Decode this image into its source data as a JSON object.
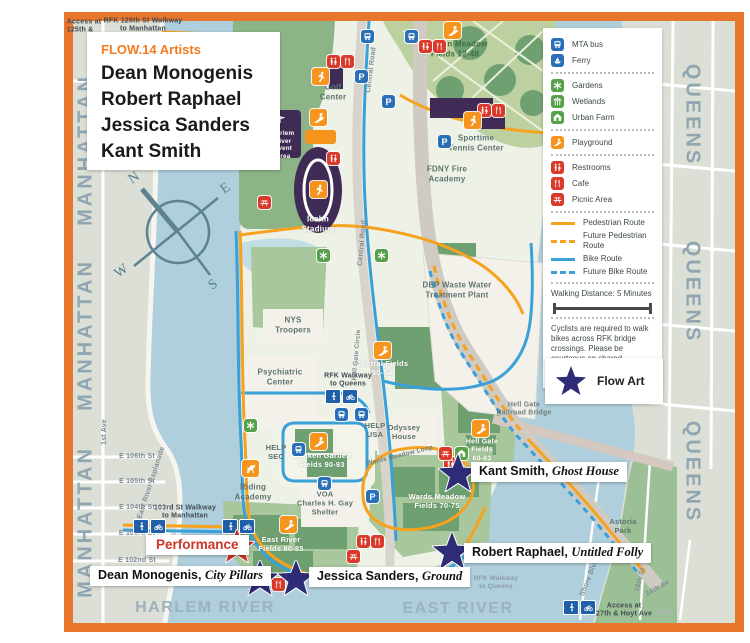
{
  "header": {
    "title": "FLOW.14 Artists",
    "artists": [
      "Dean Monogenis",
      "Robert Raphael",
      "Jessica Sanders",
      "Kant Smith"
    ]
  },
  "legend": {
    "items": [
      {
        "label": "MTA bus",
        "icon": "bus"
      },
      {
        "label": "Ferry",
        "icon": "ferry"
      },
      {
        "label": "Gardens",
        "icon": "gardens"
      },
      {
        "label": "Wetlands",
        "icon": "wetlands"
      },
      {
        "label": "Urban Farm",
        "icon": "urban-farm"
      },
      {
        "label": "Playground",
        "icon": "playground"
      },
      {
        "label": "Restrooms",
        "icon": "restrooms"
      },
      {
        "label": "Cafe",
        "icon": "cafe"
      },
      {
        "label": "Picnic Area",
        "icon": "picnic"
      }
    ],
    "routes": [
      {
        "label": "Pedestrian Route"
      },
      {
        "label": "Future Pedestrian Route"
      },
      {
        "label": "Bike Route"
      },
      {
        "label": "Future Bike Route"
      }
    ],
    "walking_distance": "Walking Distance: 5 Minutes",
    "note": "Cyclists are required to walk bikes across RFK bridge crossings. Please be courteous on shared pathways.",
    "flow_art": "Flow Art"
  },
  "compass": {
    "n": "N",
    "e": "E",
    "s": "S",
    "w": "W"
  },
  "borders": {
    "manhattan": "MANHATTAN",
    "queens": "QUEENS",
    "harlem_river": "HARLEM RIVER",
    "east_river": "EAST RIVER"
  },
  "streets": {
    "access_125": "Access at\n125th &",
    "rfk_125": "RFK 125th St Walkway\nto Manhattan",
    "first_ave": "1st Ave",
    "e106": "E 106th St",
    "e105": "E 105th St",
    "e104": "E 104th St",
    "e103": "E 103rd St",
    "e102": "E 102nd St",
    "esplanade": "East River Esplanade",
    "walkway_103": "103rd St Walkway\nto Manhattan",
    "astoria": "Astoria\nPark",
    "shore_blvd": "Shore Blvd",
    "st_19": "19th St",
    "av_24": "24th Av",
    "access_27": "Access at\n27th & Hoyt Ave",
    "map_code": "9003",
    "rfk_queens": "RFK Walkway\nto Queens"
  },
  "island": {
    "golf": "Golf\nCenter",
    "central_road": "Central Road",
    "sunken_meadow": "Sunken Meadow\nFields 12-48",
    "sportime": "Sportime\nTennis Center",
    "fdny": "FDNY Fire\nAcademy",
    "event_area": "Harlem\nRiver\nEvent\nArea",
    "field_10": "Field 10",
    "icahn": "Icahn\nStadium",
    "dep": "DEP Waste Water\nTreatment Plant",
    "nys": "NYS\nTroopers",
    "psych": "Psychiatric\nCenter",
    "rfk_walkway": "RFK Walkway\nto Queens",
    "central_fields": "Central Fields\n50-54",
    "hell_gate_circle": "Hell Gate Circle",
    "help_usa": "HELP\nUSA",
    "odyssey": "Odyssey\nHouse",
    "help_sec": "HELP\nSEC",
    "sunken_garden": "Sunken Garden\nFields 90-93",
    "wards_loop": "Wards Meadow Loop",
    "hell_gate_fields": "Hell Gate\nFields\n60-63",
    "hell_gate_bridge": "Hell Gate\nRailroad Bridge",
    "wards_fields": "Wards Meadow\nFields 70-75",
    "riding": "Riding\nAcademy",
    "voa": "VOA\nCharles H. Gay\nShelter",
    "east_river_fields": "East River\nFields 80-85"
  },
  "markers": {
    "performance": "Performance",
    "artists": [
      {
        "name": "Dean Monogenis,",
        "work": "City Pillars"
      },
      {
        "name": "Jessica Sanders,",
        "work": "Ground"
      },
      {
        "name": "Robert Raphael,",
        "work": "Untitled Folly"
      },
      {
        "name": "Kant Smith,",
        "work": "Ghost House"
      }
    ]
  },
  "icons": {
    "parking": "P"
  },
  "colors": {
    "flow_star": "#2E2B77",
    "performance_star": "#CC3128",
    "frame": "#E8762C",
    "accent": "#F47B20"
  }
}
